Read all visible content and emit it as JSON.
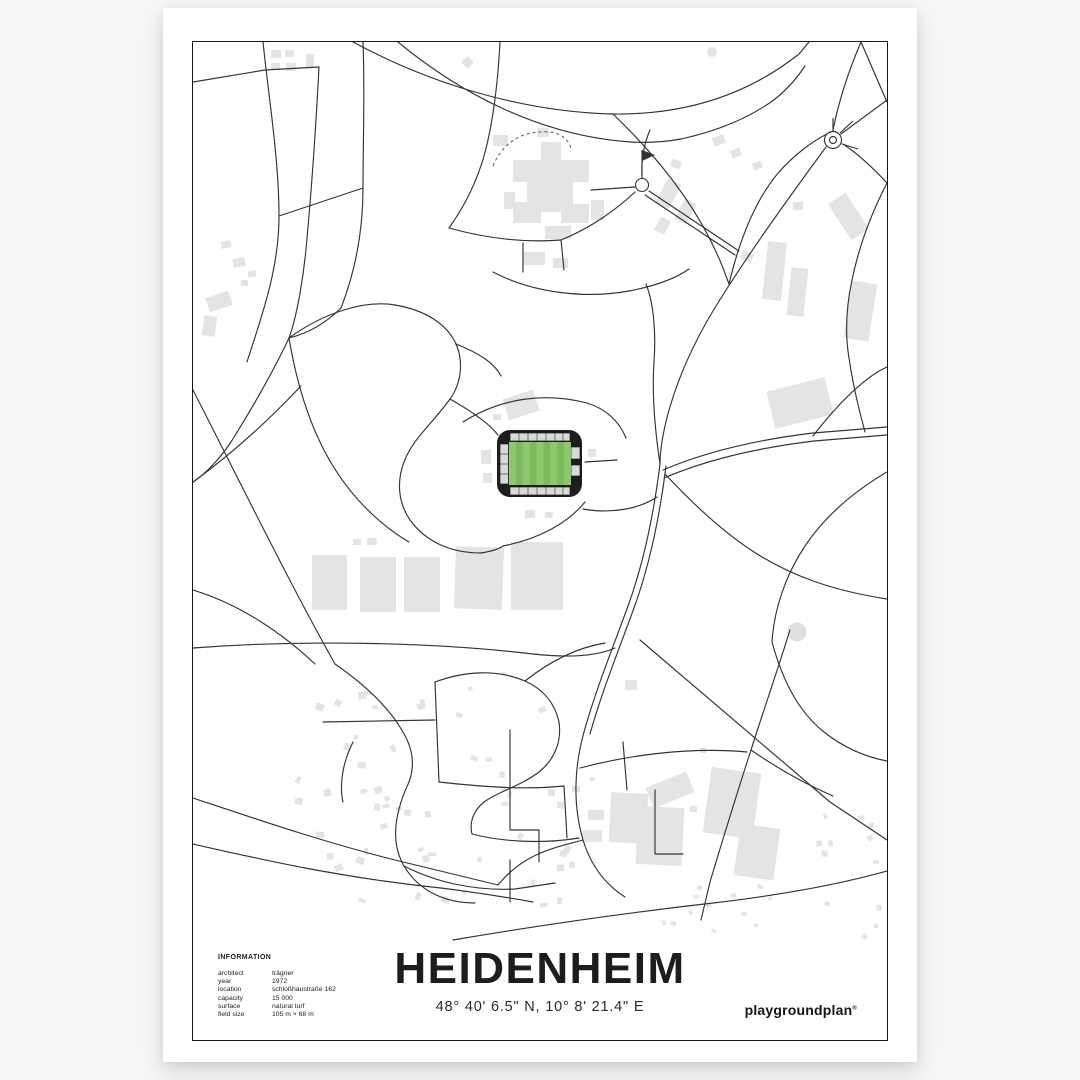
{
  "poster": {
    "title": "HEIDENHEIM",
    "coordinates": "48° 40' 6.5\" N, 10° 8' 21.4\" E",
    "brand": "playgroundplan",
    "brand_mark": "®"
  },
  "information": {
    "heading": "INFORMATION",
    "rows": [
      {
        "label": "architect",
        "value": "trägner"
      },
      {
        "label": "year",
        "value": "1972"
      },
      {
        "label": "location",
        "value": "schloßhaustraße 162"
      },
      {
        "label": "capacity",
        "value": "15 000"
      },
      {
        "label": "surface",
        "value": "natural turf"
      },
      {
        "label": "field size",
        "value": "105 m × 68 m"
      }
    ]
  },
  "map": {
    "style": "minimal-line-map",
    "road_color": "#333333",
    "building_color": "#e4e4e4",
    "background_color": "#ffffff",
    "stadium": {
      "label": "stadium",
      "structure_color": "#1d1d1d",
      "stand_color": "#d9d9d9",
      "pitch_color_dark": "#7cba5e",
      "pitch_color_light": "#8dc871",
      "pitch_stripes": 9
    },
    "landmarks": [
      "roundabout-northeast",
      "roundabout-hospital",
      "flag-marker",
      "water-tower-circle"
    ]
  }
}
